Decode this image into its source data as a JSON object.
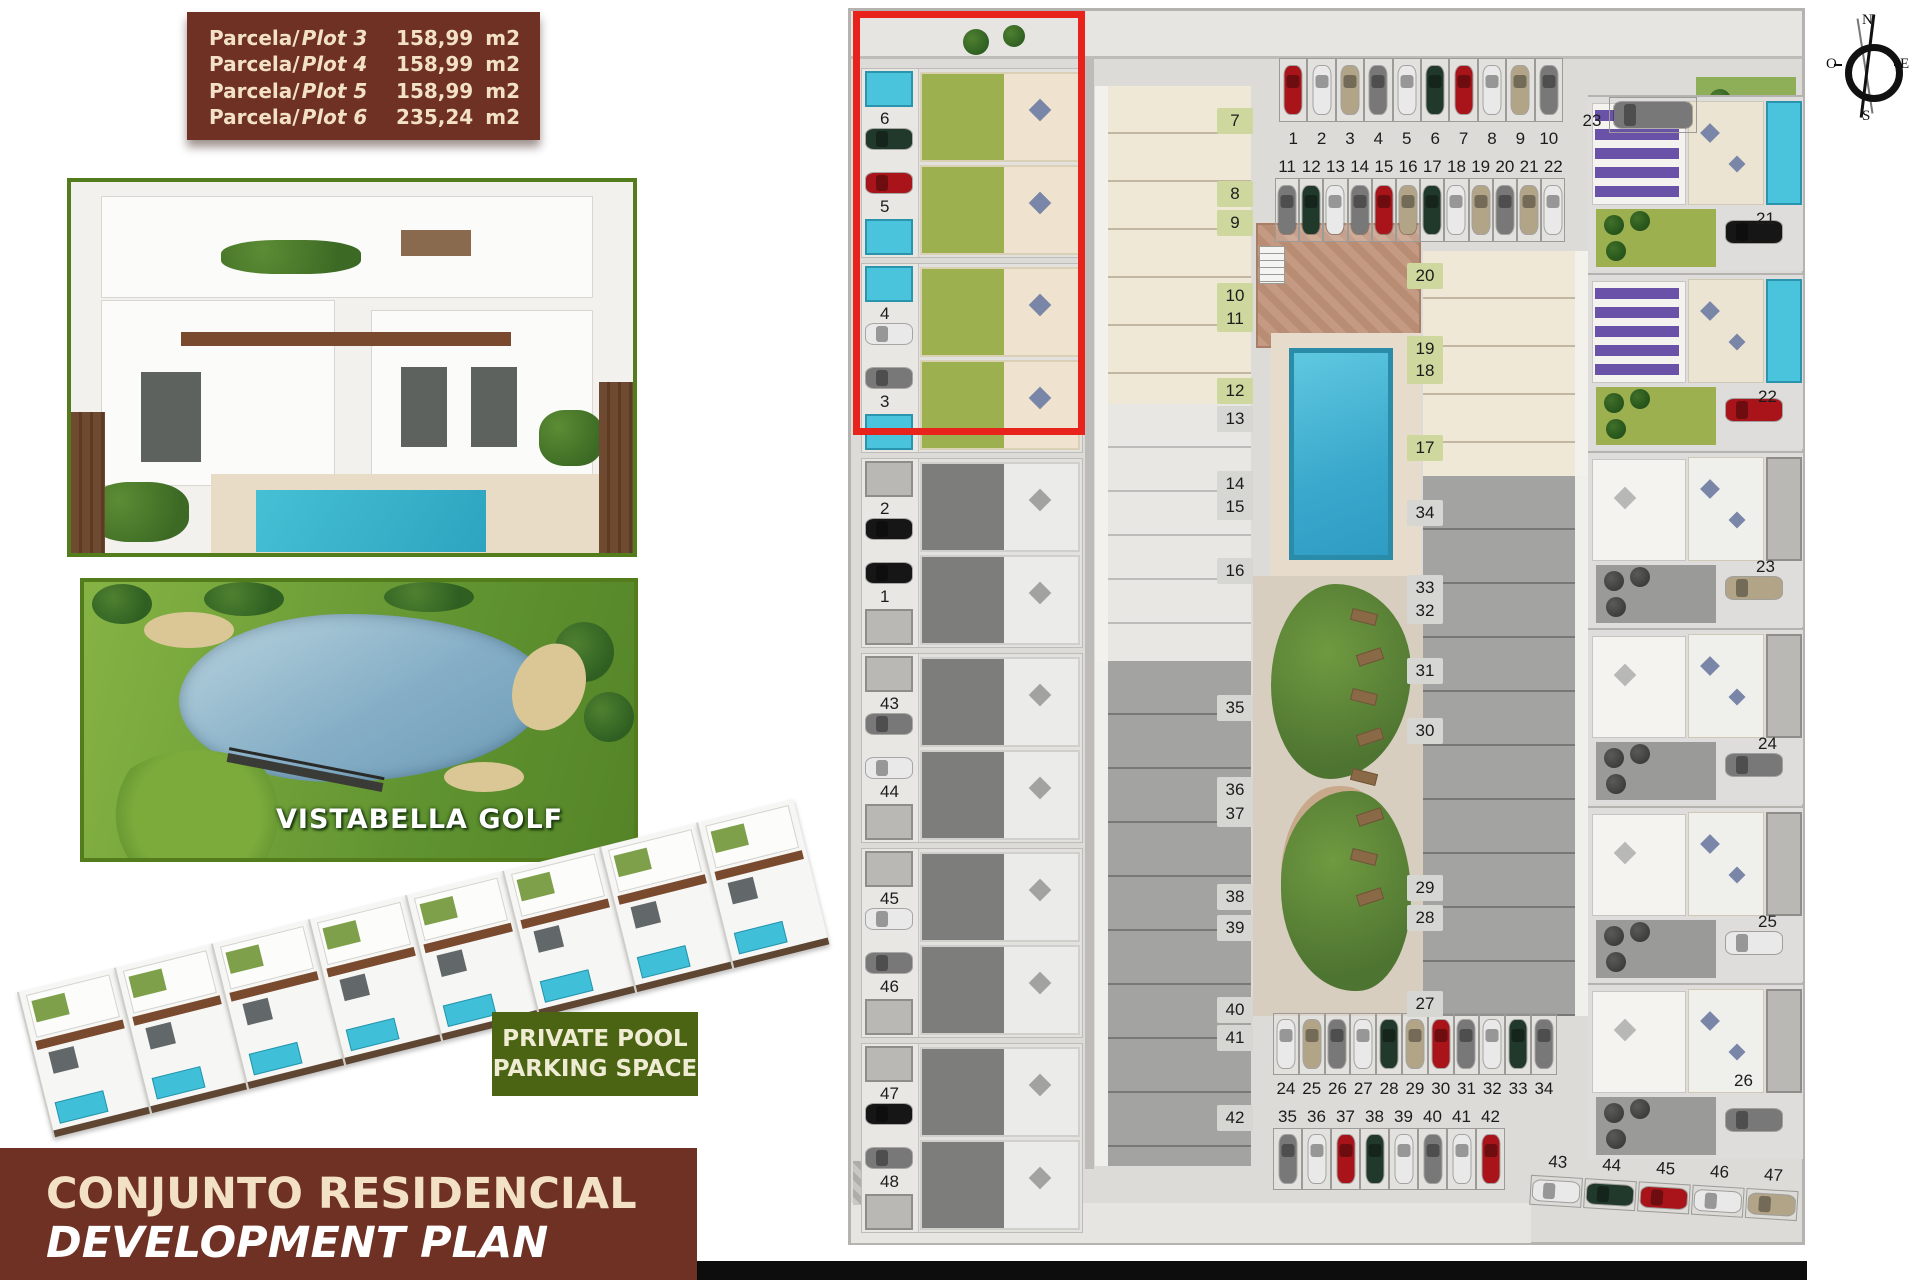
{
  "legend_table": {
    "rows": [
      {
        "prefix": "Parcela/",
        "plot": "Plot 3",
        "value": "158,99",
        "unit": "m2"
      },
      {
        "prefix": "Parcela/",
        "plot": "Plot 4",
        "value": "158,99",
        "unit": "m2"
      },
      {
        "prefix": "Parcela/",
        "plot": "Plot 5",
        "value": "158,99",
        "unit": "m2"
      },
      {
        "prefix": "Parcela/",
        "plot": "Plot 6",
        "value": "235,24",
        "unit": "m2"
      }
    ]
  },
  "golf_photo": {
    "label": "VISTABELLA GOLF"
  },
  "badge": {
    "line1": "PRIVATE POOL",
    "line2": "PARKING SPACE"
  },
  "footer": {
    "line1": "CONJUNTO RESIDENCIAL",
    "line2": "DEVELOPMENT PLAN"
  },
  "compass": {
    "north": "N",
    "south": "S",
    "east": "E",
    "west": "O"
  },
  "colors": {
    "brand_brown": "#6e3124",
    "cream": "#f3e1c6",
    "badge_green": "#4a6414",
    "photo_border_green": "#537d1c",
    "highlight_red": "#e8231c",
    "pool_cyan": "#4ac4dc",
    "garden_green": "#9cb050",
    "terrace_beige": "#efe3cf",
    "sold_gray": "#9a9a98",
    "pergola_purple": "#6a52a8"
  },
  "plan": {
    "left_column_pairs": [
      {
        "a": "6",
        "a_car": "darkgreen",
        "b": "5",
        "b_car": "red",
        "state": "available"
      },
      {
        "a": "4",
        "a_car": "white",
        "b": "3",
        "b_car": "gray",
        "state": "available"
      },
      {
        "a": "2",
        "a_car": "black",
        "b": "1",
        "b_car": "black",
        "state": "sold"
      },
      {
        "a": "43",
        "a_car": "gray",
        "b": "44",
        "b_car": "white",
        "state": "sold"
      },
      {
        "a": "45",
        "a_car": "white",
        "b": "46",
        "b_car": "gray",
        "state": "sold"
      },
      {
        "a": "47",
        "a_car": "black",
        "b": "48",
        "b_car": "gray",
        "state": "sold"
      }
    ],
    "col2_labels_green": [
      "7",
      "8",
      "9",
      "10",
      "11",
      "12"
    ],
    "col2_labels_gray": [
      "13",
      "14",
      "15",
      "16"
    ],
    "col2_labels_lower": [
      "35",
      "36",
      "37",
      "38",
      "39",
      "40",
      "41",
      "42"
    ],
    "col3_labels_green": [
      "20",
      "19",
      "18",
      "17"
    ],
    "col3_labels_gray": [
      "34",
      "33",
      "32",
      "31",
      "30",
      "29",
      "28",
      "27"
    ],
    "right_column_units": [
      {
        "id": "21",
        "state": "available",
        "car": "black"
      },
      {
        "id": "22",
        "state": "available",
        "car": "red"
      },
      {
        "id": "23",
        "state": "sold",
        "car": "beige"
      },
      {
        "id": "24",
        "state": "sold",
        "car": "gray"
      },
      {
        "id": "25",
        "state": "sold",
        "car": "white"
      },
      {
        "id": "26",
        "state": "sold",
        "car": "gray"
      }
    ],
    "parking": {
      "row_top": {
        "numbers": [
          "1",
          "2",
          "3",
          "4",
          "5",
          "6",
          "7",
          "8",
          "9",
          "10"
        ],
        "cars": [
          "red",
          "white",
          "beige",
          "gray",
          "white",
          "darkgreen",
          "red",
          "white",
          "beige",
          "gray"
        ]
      },
      "row_second": {
        "numbers": [
          "11",
          "12",
          "13",
          "14",
          "15",
          "16",
          "17",
          "18",
          "19",
          "20",
          "21",
          "22"
        ],
        "cars": [
          "gray",
          "darkgreen",
          "white",
          "gray",
          "red",
          "beige",
          "darkgreen",
          "white",
          "beige",
          "gray",
          "beige",
          "white"
        ]
      },
      "space_23": {
        "number": "23",
        "car": "gray"
      },
      "row_bottom": {
        "numbers": [
          "24",
          "25",
          "26",
          "27",
          "28",
          "29",
          "30",
          "31",
          "32",
          "33",
          "34"
        ],
        "cars": [
          "white",
          "beige",
          "gray",
          "white",
          "darkgreen",
          "beige",
          "red",
          "gray",
          "white",
          "darkgreen",
          "gray"
        ]
      },
      "row_bottom2": {
        "numbers": [
          "35",
          "36",
          "37",
          "38",
          "39",
          "40",
          "41",
          "42"
        ],
        "cars": [
          "gray",
          "white",
          "red",
          "darkgreen",
          "white",
          "gray",
          "white",
          "red"
        ]
      },
      "row_right": {
        "numbers": [
          "43",
          "44",
          "45",
          "46",
          "47"
        ],
        "cars": [
          "white",
          "darkgreen",
          "red",
          "white",
          "beige"
        ]
      }
    },
    "car_palette": {
      "red": "#a8141a",
      "white": "#e9e9e9",
      "beige": "#b2a487",
      "gray": "#787878",
      "darkgreen": "#21392b",
      "black": "#161616"
    }
  }
}
